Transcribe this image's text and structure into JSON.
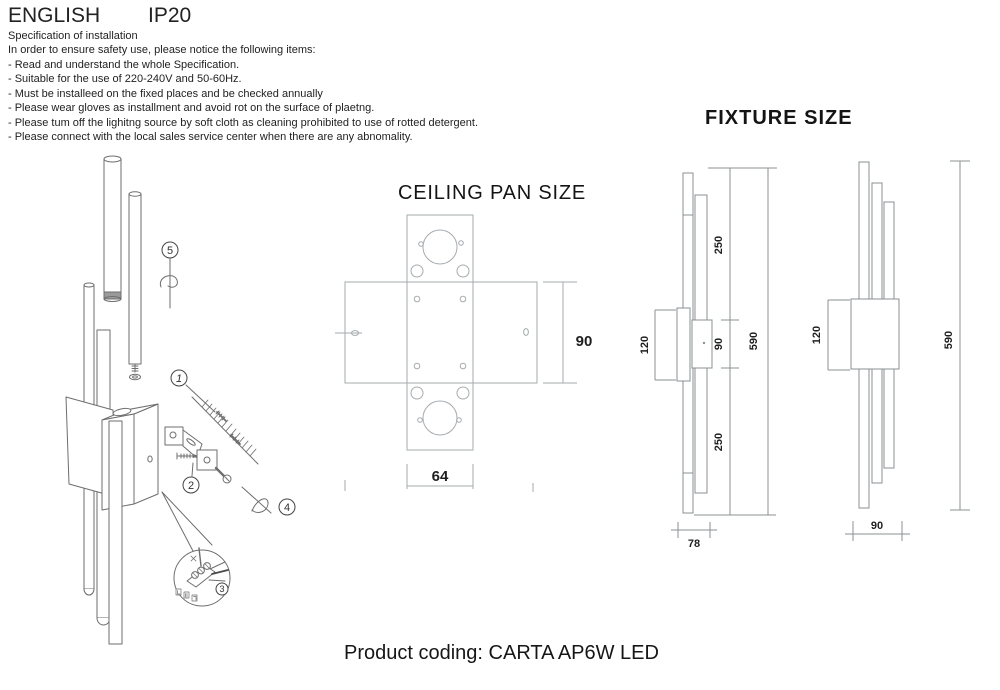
{
  "header": {
    "language": "ENGLISH",
    "ip_rating": "IP20"
  },
  "spec": {
    "title": "Specification of installation",
    "intro": "In order to ensure safety use, please notice the following items:",
    "items": [
      "- Read and understand the whole Specification.",
      "- Suitable for the use of 220-240V and 50-60Hz.",
      "- Must be installeed on the fixed places and be checked annually",
      "- Please wear gloves as installment and avoid rot on the surface of plaetng.",
      "- Please tum off the lighitng source by soft cloth as cleaning prohibited to use of rotted detergent.",
      "- Please connect with the local sales service center when there are any abnomality."
    ]
  },
  "installation": {
    "steps": {
      "s1": "1",
      "s2": "2",
      "s3": "3",
      "s4": "4",
      "s5": "5"
    }
  },
  "ceiling_pan": {
    "title": "CEILING PAN SIZE",
    "dim_width": "64",
    "dim_height": "90"
  },
  "fixture": {
    "title": "FIXTURE SIZE",
    "side_view": {
      "seg_top": "250",
      "seg_mid": "90",
      "seg_bottom": "250",
      "total": "590",
      "bracket": "120",
      "depth": "78"
    },
    "front_view": {
      "bracket": "120",
      "total": "590",
      "width": "90"
    }
  },
  "footer": {
    "product_coding": "Product coding: CARTA AP6W LED"
  },
  "colors": {
    "background": "#ffffff",
    "text": "#1a1a1a",
    "installation_lines": "#6e6e6e",
    "ceiling_pan_lines": "#a6abae",
    "fixture_lines": "#8b9093"
  }
}
